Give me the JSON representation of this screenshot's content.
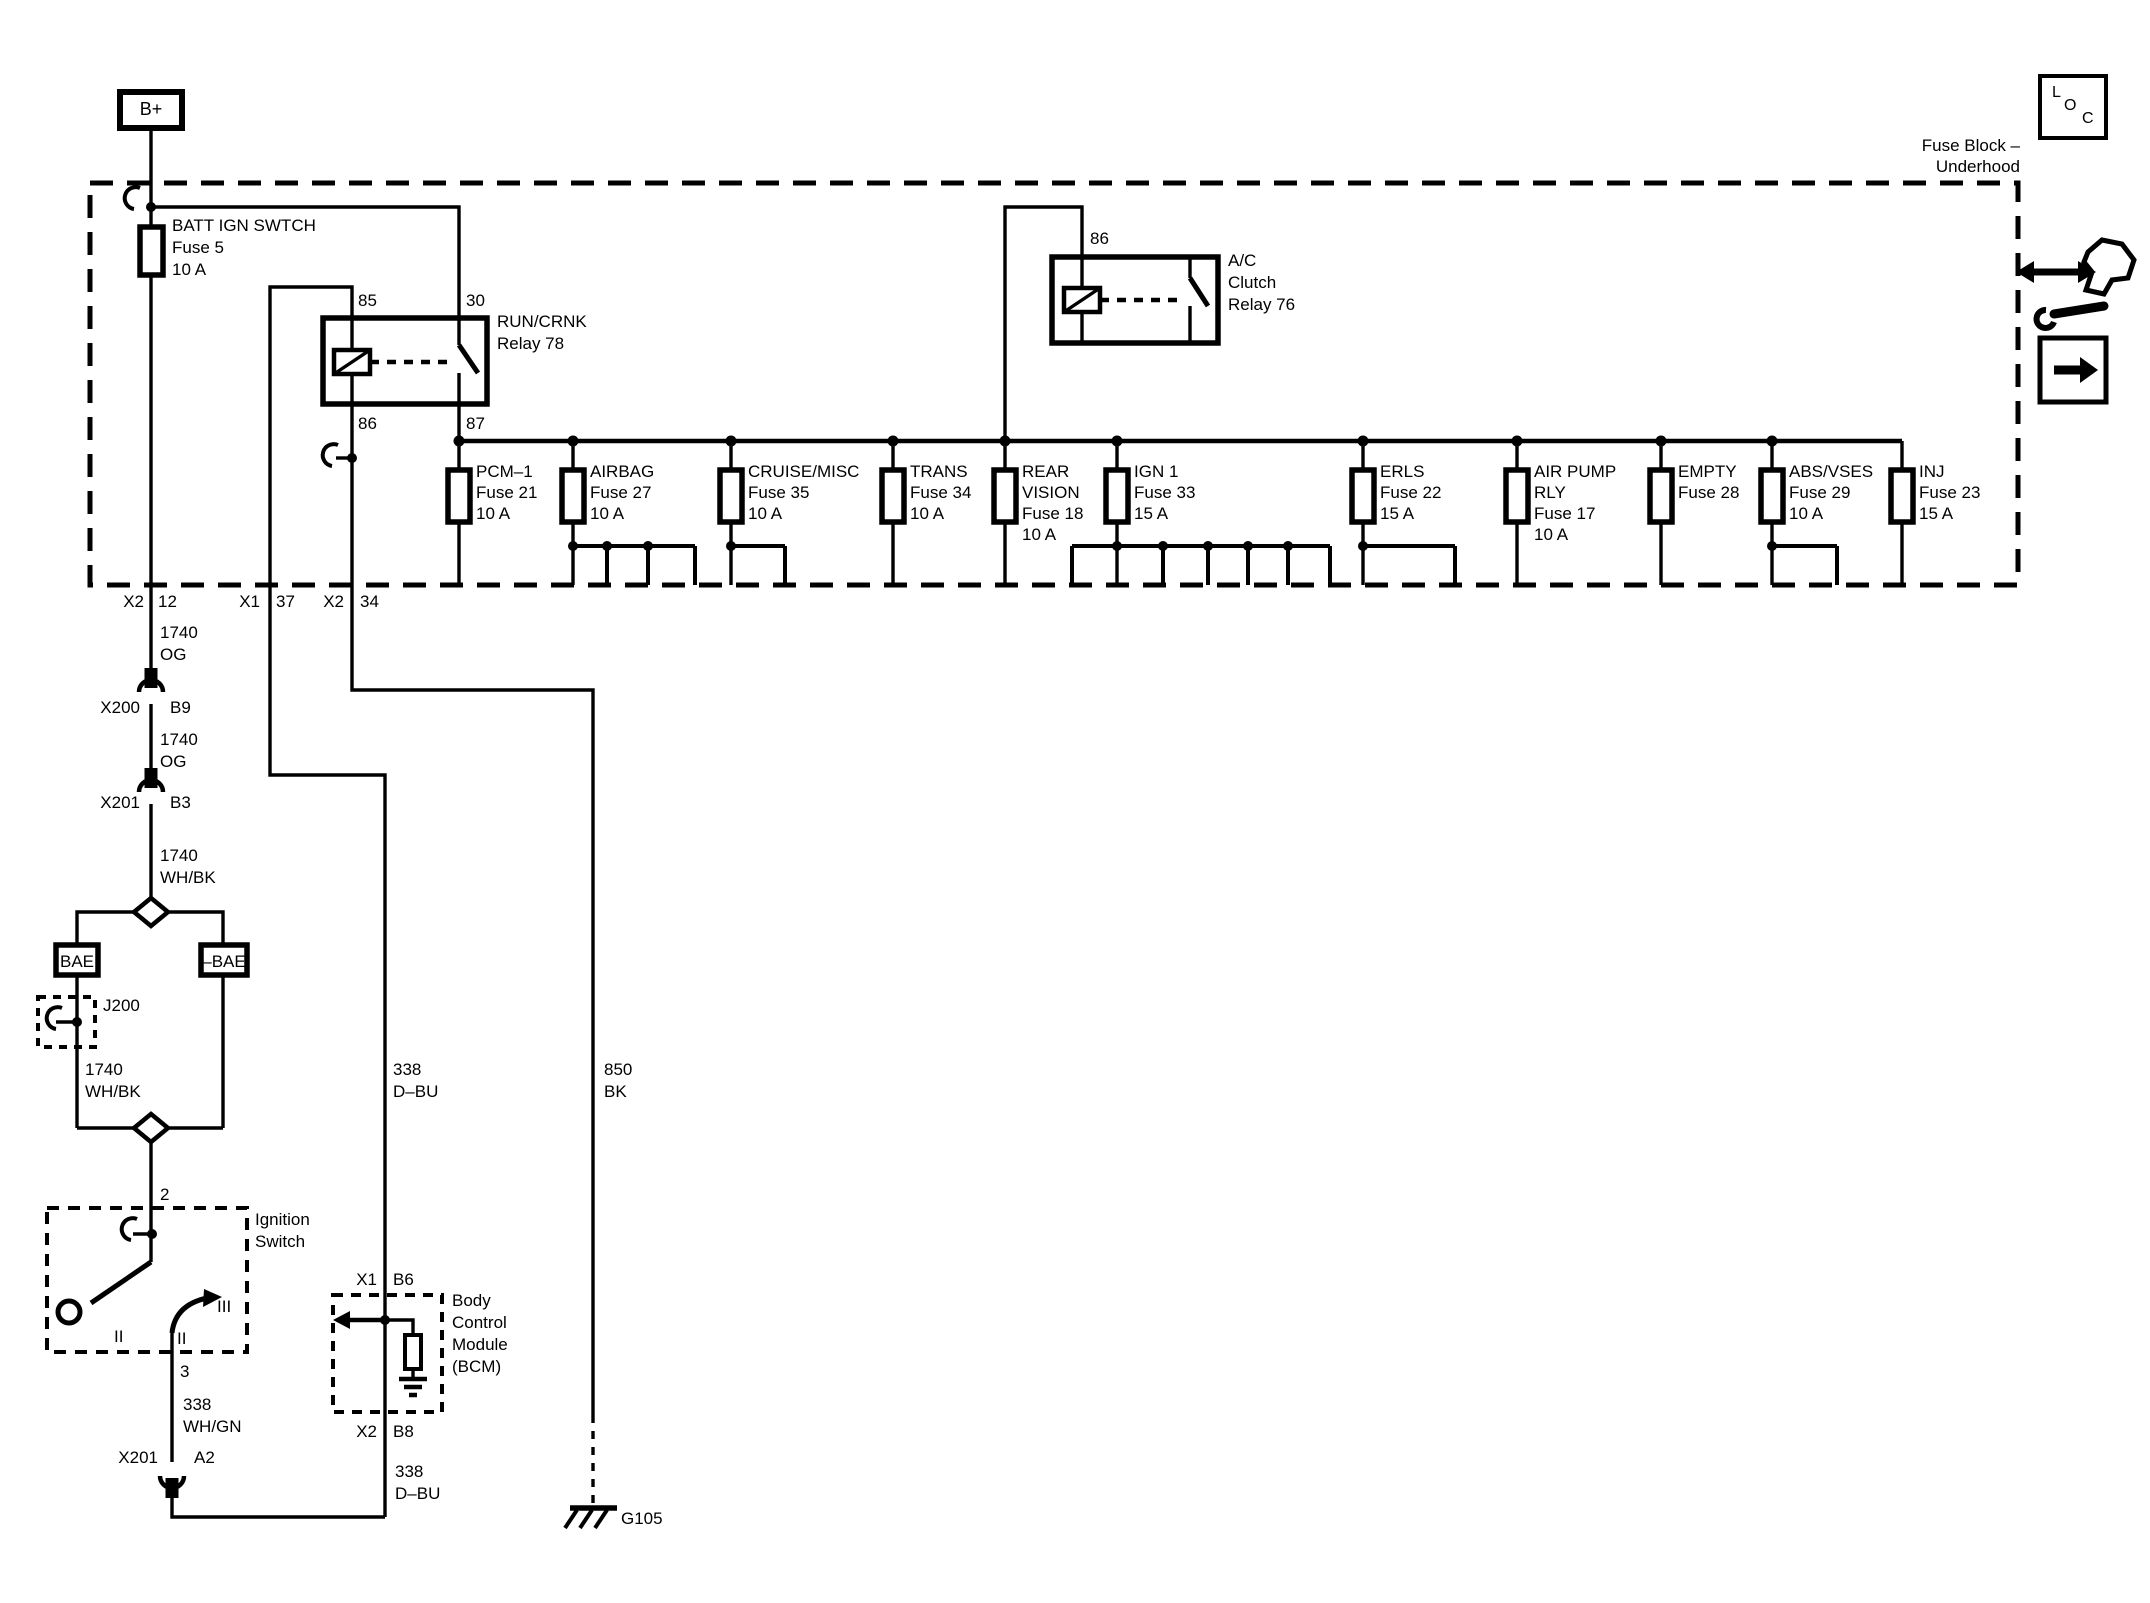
{
  "legend": {
    "title_line1": "Fuse Block –",
    "title_line2": "Underhood",
    "loc": {
      "l": "L",
      "o": "O",
      "c": "C"
    }
  },
  "battery": {
    "b_plus": "B+"
  },
  "fuse5": {
    "lines": [
      "BATT IGN SWTCH",
      "Fuse 5",
      "10 A"
    ]
  },
  "run_crnk_relay": {
    "lines": [
      "RUN/CRNK",
      "Relay 78"
    ],
    "pins": {
      "p85": "85",
      "p30": "30",
      "p86": "86",
      "p87": "87"
    }
  },
  "ac_relay": {
    "lines": [
      "A/C",
      "Clutch",
      "Relay 76"
    ],
    "pins": {
      "p86": "86"
    }
  },
  "fuse_row": [
    {
      "lines": [
        "PCM–1",
        "Fuse 21",
        "10 A"
      ]
    },
    {
      "lines": [
        "AIRBAG",
        "Fuse 27",
        "10 A"
      ]
    },
    {
      "lines": [
        "CRUISE/MISC",
        "Fuse 35",
        "10 A"
      ]
    },
    {
      "lines": [
        "TRANS",
        "Fuse 34",
        "10 A"
      ]
    },
    {
      "lines": [
        "REAR",
        "VISION",
        "Fuse 18",
        "10 A"
      ]
    },
    {
      "lines": [
        "IGN 1",
        "Fuse 33",
        "15 A"
      ]
    },
    {
      "lines": [
        "ERLS",
        "Fuse 22",
        "15 A"
      ]
    },
    {
      "lines": [
        "AIR PUMP",
        "RLY",
        "Fuse 17",
        "10 A"
      ]
    },
    {
      "lines": [
        "EMPTY",
        "Fuse 28"
      ]
    },
    {
      "lines": [
        "ABS/VSES",
        "Fuse 29",
        "10 A"
      ]
    },
    {
      "lines": [
        "INJ",
        "Fuse 23",
        "15 A"
      ]
    }
  ],
  "block_exits": [
    {
      "conn": "X2",
      "pin": "12"
    },
    {
      "conn": "X1",
      "pin": "37"
    },
    {
      "conn": "X2",
      "pin": "34"
    }
  ],
  "wire_labels": {
    "w1740og_a": {
      "circuit": "1740",
      "color": "OG"
    },
    "w1740og_b": {
      "circuit": "1740",
      "color": "OG"
    },
    "w1740whbk_a": {
      "circuit": "1740",
      "color": "WH/BK"
    },
    "w1740whbk_b": {
      "circuit": "1740",
      "color": "WH/BK"
    },
    "w338dbu_a": {
      "circuit": "338",
      "color": "D–BU"
    },
    "w338dbu_b": {
      "circuit": "338",
      "color": "D–BU"
    },
    "w338whgn": {
      "circuit": "338",
      "color": "WH/GN"
    },
    "w850bk": {
      "circuit": "850",
      "color": "BK"
    }
  },
  "connectors": {
    "x200": {
      "name": "X200",
      "pin": "B9"
    },
    "x201_b3": {
      "name": "X201",
      "pin": "B3"
    },
    "x201_a2": {
      "name": "X201",
      "pin": "A2"
    },
    "j200": {
      "name": "J200"
    }
  },
  "options": {
    "left": "BAE",
    "right": "–BAE"
  },
  "ignition_switch": {
    "lines": [
      "Ignition",
      "Switch"
    ],
    "pin_in": "2",
    "pin_out": "3",
    "positions": {
      "left": "II",
      "mid": "II",
      "crank": "III"
    }
  },
  "bcm": {
    "lines": [
      "Body",
      "Control",
      "Module",
      "(BCM)"
    ],
    "conn_top": {
      "conn": "X1",
      "pin": "B6"
    },
    "conn_bottom": {
      "conn": "X2",
      "pin": "B8"
    }
  },
  "ground": {
    "label": "G105"
  }
}
